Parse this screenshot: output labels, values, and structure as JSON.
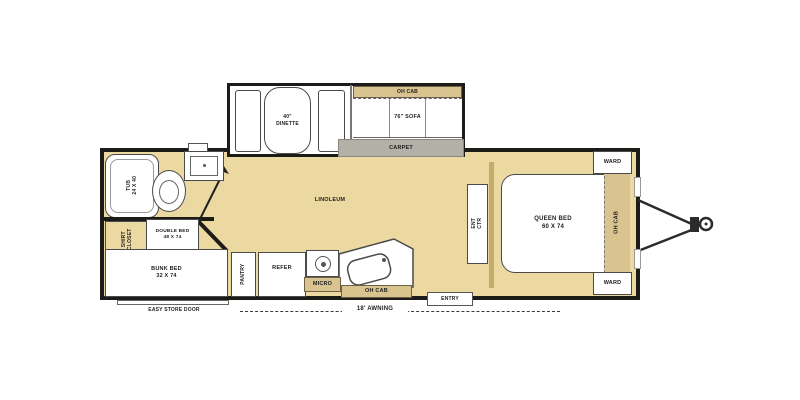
{
  "labels": {
    "dinette_line1": "40\"",
    "dinette_line2": "DINETTE",
    "oh_cab": "OH CAB",
    "sofa": "76\" SOFA",
    "carpet": "CARPET",
    "tub_line1": "TUB",
    "tub_line2": "24 X 40",
    "shirt_line1": "SHIRT",
    "shirt_line2": "CLOSET",
    "double_bed_line1": "DOUBLE BED",
    "double_bed_line2": "48 X 74",
    "bunk_bed_line1": "BUNK BED",
    "bunk_bed_line2": "32 X 74",
    "easy_store_door": "EASY STORE DOOR",
    "pantry": "PANTRY",
    "refer": "REFER",
    "micro": "MICRO",
    "linoleum": "LINOLEUM",
    "ent_ctr_line1": "ENT",
    "ent_ctr_line2": "CTR",
    "queen_line1": "QUEEN BED",
    "queen_line2": "60 X 74",
    "ward": "WARD",
    "entry": "ENTRY",
    "awning": "18' AWNING"
  },
  "colors": {
    "wall": "#1d1b18",
    "floor": "#ecd9a1",
    "carpet": "#b3b0a8",
    "cabinet": "#d9c48f",
    "divider": "#c4ab6e",
    "outline": "#4a4a4a"
  }
}
